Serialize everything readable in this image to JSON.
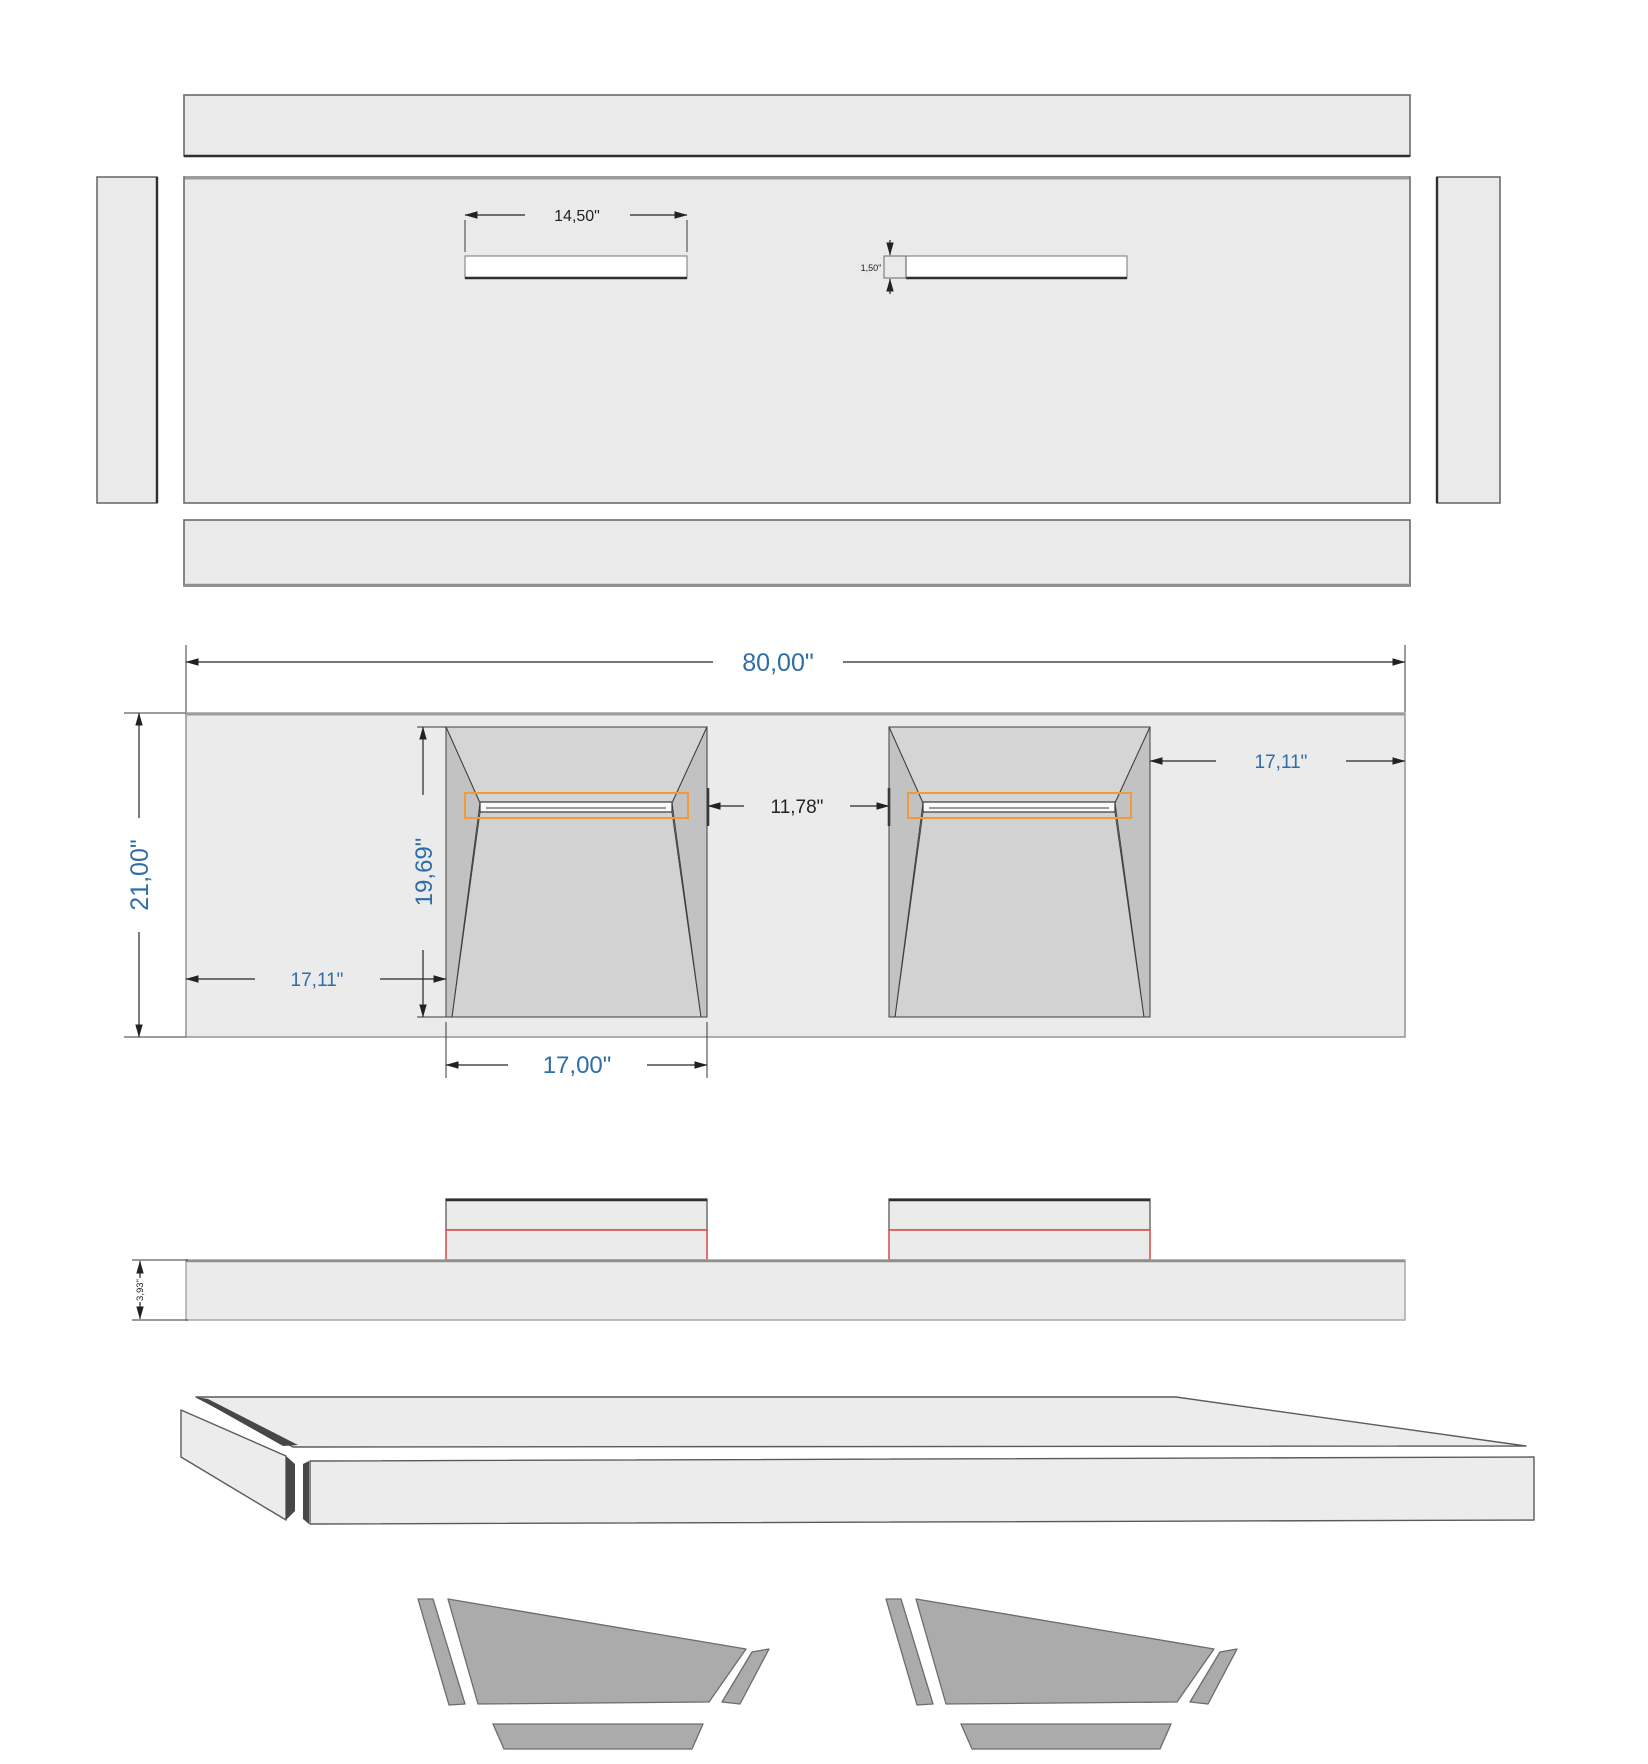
{
  "drawing": {
    "dims": {
      "overall_width": "80,00\"",
      "overall_depth": "21,00\"",
      "basin_length": "19,69\"",
      "basin_width": "17,00\"",
      "offset_left": "17,11\"",
      "offset_right": "17,11\"",
      "between_basins": "11,78\"",
      "slot_width": "14,50\"",
      "slot_height": "1,50\"",
      "slab_thickness": "3,93\""
    },
    "colors": {
      "dim_blue": "#2e6da8",
      "dim_dark": "#222222",
      "highlight_orange": "#f09a3c",
      "highlight_red": "#d9534f",
      "panel_fill": "#eaeaea",
      "basin_wall": "#c2c2c2",
      "part_gray": "#ababab"
    }
  }
}
